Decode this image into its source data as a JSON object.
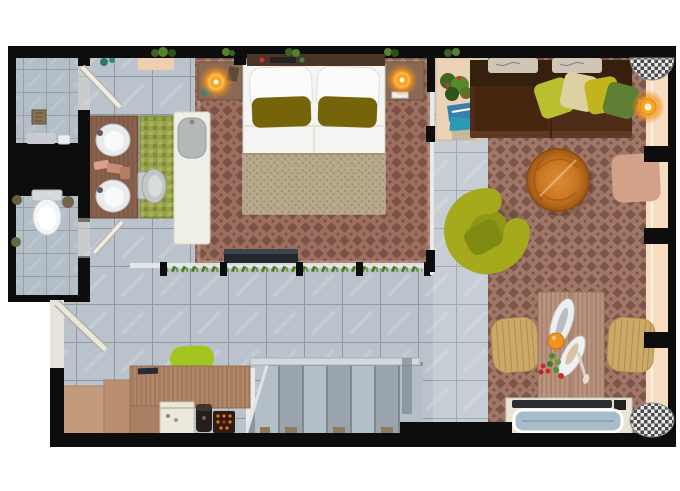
{
  "meta": {
    "title": "apartment-floor-plan",
    "view": "top-down rendered floor plan, no visible text labels"
  },
  "palette": {
    "page_bg": "#ffffff",
    "wall": "#0d0d0d",
    "tile_base": "#bac3cb",
    "tile_grout": "#8f99a2",
    "tile_small": "#b3bec7",
    "carpet_base": "#a17868",
    "carpet_motif": "#7d564b",
    "blanket": "#b6a68a",
    "pillow_olive": "#756409",
    "sofa": "#4e2c18",
    "sofa_back": "#35200e",
    "pillow_green": "#b8c030",
    "pillow_cream": "#ddd0a2",
    "pillow_mustard": "#c3b31c",
    "pillow_forest": "#5e7e33",
    "coffee_table": "#cb7722",
    "ottoman": "#d2a187",
    "armchair": "#a4aa1b",
    "lamp_core": "#f5a623",
    "dining_table": "#bb9480",
    "dining_chair": "#cda967",
    "desk_wood": "#b18669",
    "chair_lime": "#a3c51f",
    "bath_mat": "#97a24b",
    "balcony": "#f6dcc0",
    "stairs_light": "#b4bec6",
    "stairs_dark": "#9aa4ac"
  },
  "rooms": [
    {
      "id": "shower-room",
      "label": "Shower room",
      "furniture": [
        "floor-drain",
        "towel"
      ]
    },
    {
      "id": "wc",
      "label": "WC",
      "furniture": [
        "toilet",
        "toilet-brush",
        "waste-bin"
      ]
    },
    {
      "id": "vanity-area",
      "label": "Vanity area",
      "furniture": [
        "double-sink-counter",
        "green-bath-mat",
        "bidet",
        "bathtub"
      ]
    },
    {
      "id": "bedroom",
      "label": "Bedroom",
      "furniture": [
        "double-bed",
        "white-pillows",
        "olive-pillows",
        "nightstand-left",
        "nightstand-right",
        "bedside-lamps",
        "tv-bench",
        "low-partition"
      ]
    },
    {
      "id": "hallway",
      "label": "Hallway",
      "furniture": [
        "staircase",
        "entry-door"
      ]
    },
    {
      "id": "workspace",
      "label": "Desk / kitchenette",
      "furniture": [
        "desk",
        "lime-desk-chair",
        "minibar",
        "coffee-machine",
        "snack-box",
        "step-cabinets"
      ]
    },
    {
      "id": "living-room",
      "label": "Living room",
      "furniture": [
        "corner-sofa",
        "sofa-cushions",
        "round-coffee-table",
        "ottoman",
        "swivel-armchair",
        "floor-lamp",
        "plant-shelf",
        "magazines",
        "checkered-pouf"
      ]
    },
    {
      "id": "dining-area",
      "label": "Dining area",
      "furniture": [
        "dining-table",
        "dining-chair-left",
        "dining-chair-right",
        "food-setting",
        "storage-bench",
        "checkered-pouf"
      ]
    },
    {
      "id": "balcony",
      "label": "Window ledge",
      "furniture": []
    }
  ]
}
